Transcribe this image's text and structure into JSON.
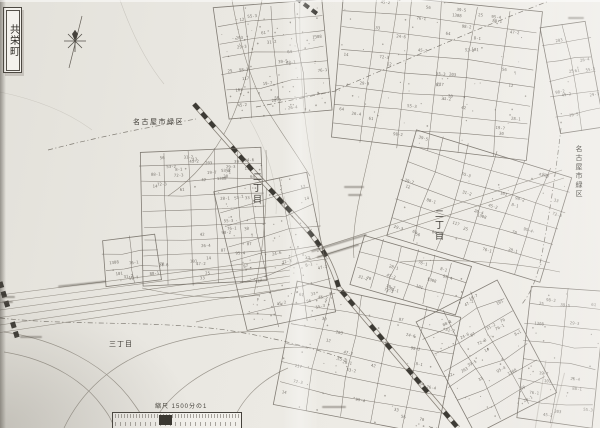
{
  "map": {
    "town_title": "共栄町",
    "labels": {
      "boundary_top": "名古屋市緑区",
      "boundary_right": "名古屋市緑区",
      "chome_left": "二丁目",
      "chome_right": "二丁目",
      "chome_bottom_left": "三丁目"
    },
    "scale": {
      "label": "縮尺 1500分の1"
    },
    "icons": {
      "north_arrow": "compass-star-icon"
    },
    "colors": {
      "paper": "#eae8e2",
      "ink": "#6e6860",
      "rail": "#2e2b26",
      "label": "#3c3933"
    },
    "parcel_numbers": [
      "28-1",
      "29-3",
      "30",
      "31-2",
      "25",
      "24-6",
      "101",
      "98-2",
      "87",
      "76-1",
      "55-3",
      "42",
      "1308",
      "45-2",
      "33",
      "19-7",
      "64",
      "72-3",
      "88-1",
      "56",
      "47-2",
      "39-5",
      "12",
      "8-1",
      "203",
      "117",
      "95-4",
      "61",
      "53-2",
      "70",
      "26-4",
      "14"
    ],
    "clusters": [
      {
        "name": "north-left",
        "x": 222,
        "y": 4,
        "w": 104,
        "h": 112,
        "rot": -6,
        "rows": 7,
        "cols": 4,
        "nums": 20,
        "dots": 80,
        "jit": 3
      },
      {
        "name": "north-right",
        "x": 337,
        "y": 2,
        "w": 196,
        "h": 148,
        "rot": 6,
        "rows": 8,
        "cols": 6,
        "nums": 38,
        "dots": 50,
        "jit": 2.5
      },
      {
        "name": "east-mid",
        "x": 398,
        "y": 150,
        "w": 164,
        "h": 110,
        "rot": 17,
        "rows": 6,
        "cols": 6,
        "nums": 26,
        "dots": 15,
        "jit": 2.5
      },
      {
        "name": "far-northeast",
        "x": 549,
        "y": 24,
        "w": 47,
        "h": 106,
        "rot": -10,
        "rows": 6,
        "cols": 2,
        "nums": 9,
        "dots": 4,
        "jit": 2
      },
      {
        "name": "west-grid",
        "x": 142,
        "y": 150,
        "w": 122,
        "h": 134,
        "rot": -2,
        "rows": 9,
        "cols": 5,
        "nums": 40,
        "dots": 8,
        "jit": 1.5
      },
      {
        "name": "west-grid-south",
        "x": 104,
        "y": 236,
        "w": 54,
        "h": 48,
        "rot": -7,
        "rows": 3,
        "cols": 2,
        "nums": 6,
        "dots": 2,
        "jit": 1.5
      },
      {
        "name": "center-slope",
        "x": 232,
        "y": 180,
        "w": 92,
        "h": 144,
        "rot": -13,
        "rows": 8,
        "cols": 3,
        "nums": 16,
        "dots": 110,
        "jit": 3.5
      },
      {
        "name": "mid-strip",
        "x": 356,
        "y": 250,
        "w": 110,
        "h": 50,
        "rot": 17,
        "rows": 3,
        "cols": 6,
        "nums": 12,
        "dots": 8,
        "jit": 2
      },
      {
        "name": "south-mid",
        "x": 284,
        "y": 298,
        "w": 166,
        "h": 122,
        "rot": 11,
        "rows": 6,
        "cols": 5,
        "nums": 26,
        "dots": 35,
        "jit": 2.5
      },
      {
        "name": "south-east-fan",
        "x": 440,
        "y": 294,
        "w": 90,
        "h": 126,
        "rot": -28,
        "rows": 7,
        "cols": 3,
        "nums": 20,
        "dots": 40,
        "jit": 3
      },
      {
        "name": "far-southeast",
        "x": 523,
        "y": 288,
        "w": 74,
        "h": 134,
        "rot": 6,
        "rows": 7,
        "cols": 2,
        "nums": 14,
        "dots": 15,
        "jit": 2.5
      }
    ]
  }
}
